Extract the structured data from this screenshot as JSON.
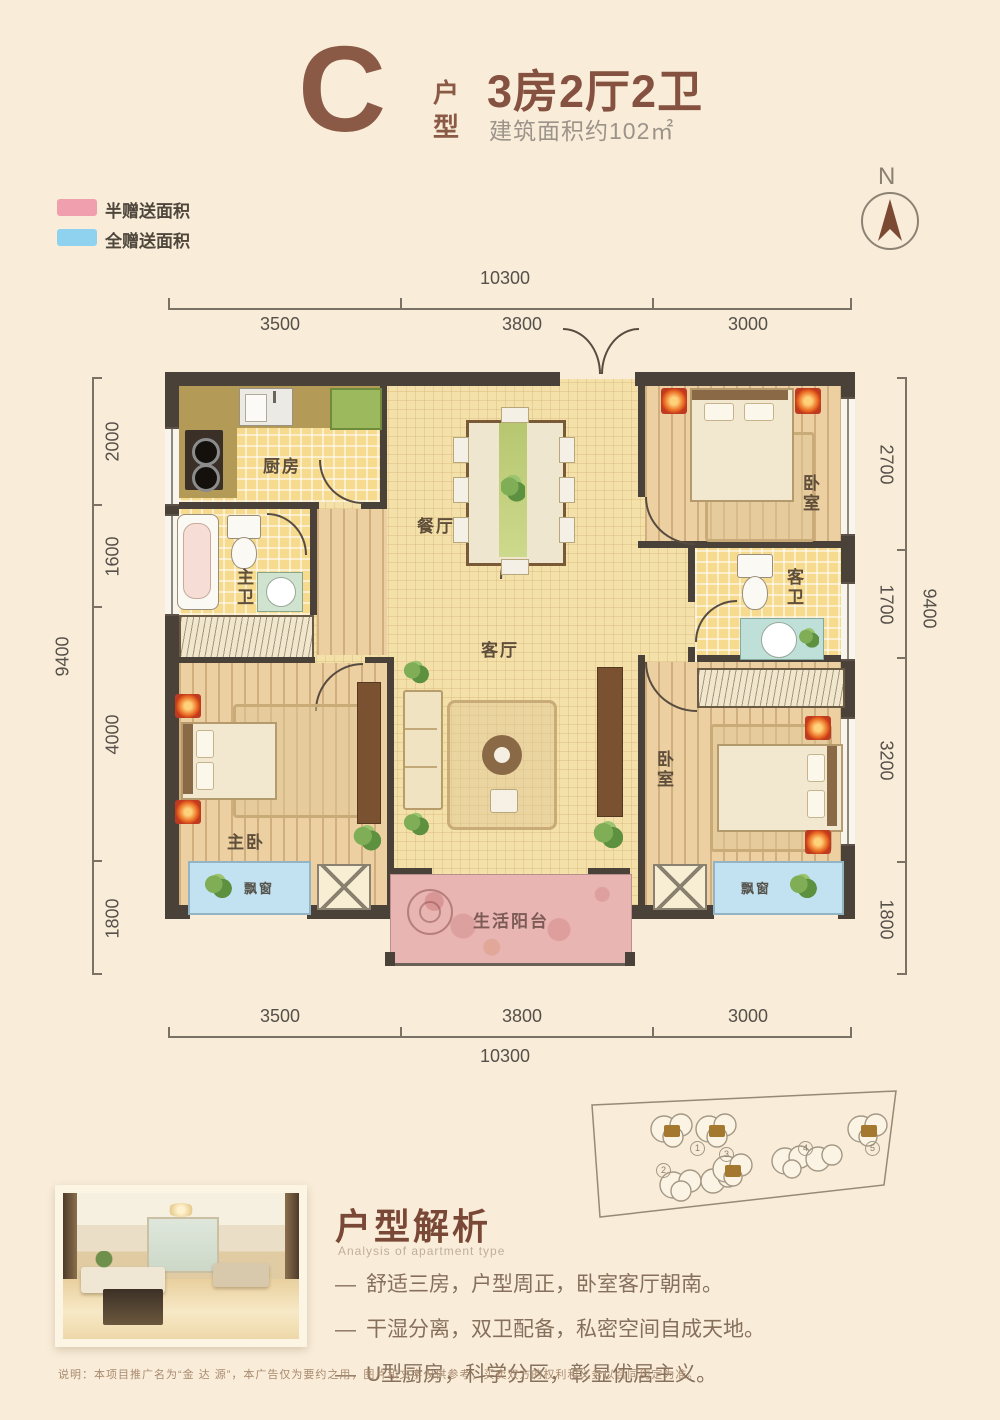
{
  "header": {
    "letter": "C",
    "letter_label": "户型",
    "title": "3房2厅2卫",
    "area": "建筑面积约102㎡"
  },
  "legend": {
    "items": [
      {
        "label": "半赠送面积",
        "color": "#ef9fae"
      },
      {
        "label": "全赠送面积",
        "color": "#8ed2f0"
      }
    ]
  },
  "compass": {
    "north": "N"
  },
  "dimensions": {
    "top": {
      "total": "10300",
      "segments": [
        "3500",
        "3800",
        "3000"
      ]
    },
    "bottom": {
      "total": "10300",
      "segments": [
        "3500",
        "3800",
        "3000"
      ]
    },
    "left": {
      "total": "9400",
      "segments": [
        "2000",
        "1600",
        "4000",
        "1800"
      ]
    },
    "right": {
      "total": "9400",
      "segments": [
        "2700",
        "1700",
        "3200",
        "1800"
      ]
    }
  },
  "rooms": {
    "kitchen": "厨房",
    "dining": "餐厅",
    "living": "客厅",
    "master_bedroom": "主卧",
    "bedroom_top_right": "卧室",
    "bedroom_bottom_right": "卧室",
    "master_bath": "主卫",
    "guest_bath": "客卫",
    "bay_window": "飘窗",
    "balcony": "生活阳台"
  },
  "site_plan": {
    "numbers": [
      "1",
      "2",
      "3",
      "4",
      "5"
    ]
  },
  "analysis": {
    "title": "户型解析",
    "subtitle": "Analysis of apartment type",
    "bullet": "—",
    "points": [
      "舒适三房，户型周正，卧室客厅朝南。",
      "干湿分离，双卫配备，私密空间自成天地。",
      "U型厨房，科学分区，彰显优居主义。"
    ]
  },
  "disclaimer": "说明：本项目推广名为“金 达 源”，本广告仅为要约之用，图片和文字仅供参考，买卖双方的权利和义务以合同约定为准。",
  "colors": {
    "brand_brown": "#8a5a47",
    "half_gift_pink": "#ef9fae",
    "full_gift_blue": "#8ed2f0"
  }
}
